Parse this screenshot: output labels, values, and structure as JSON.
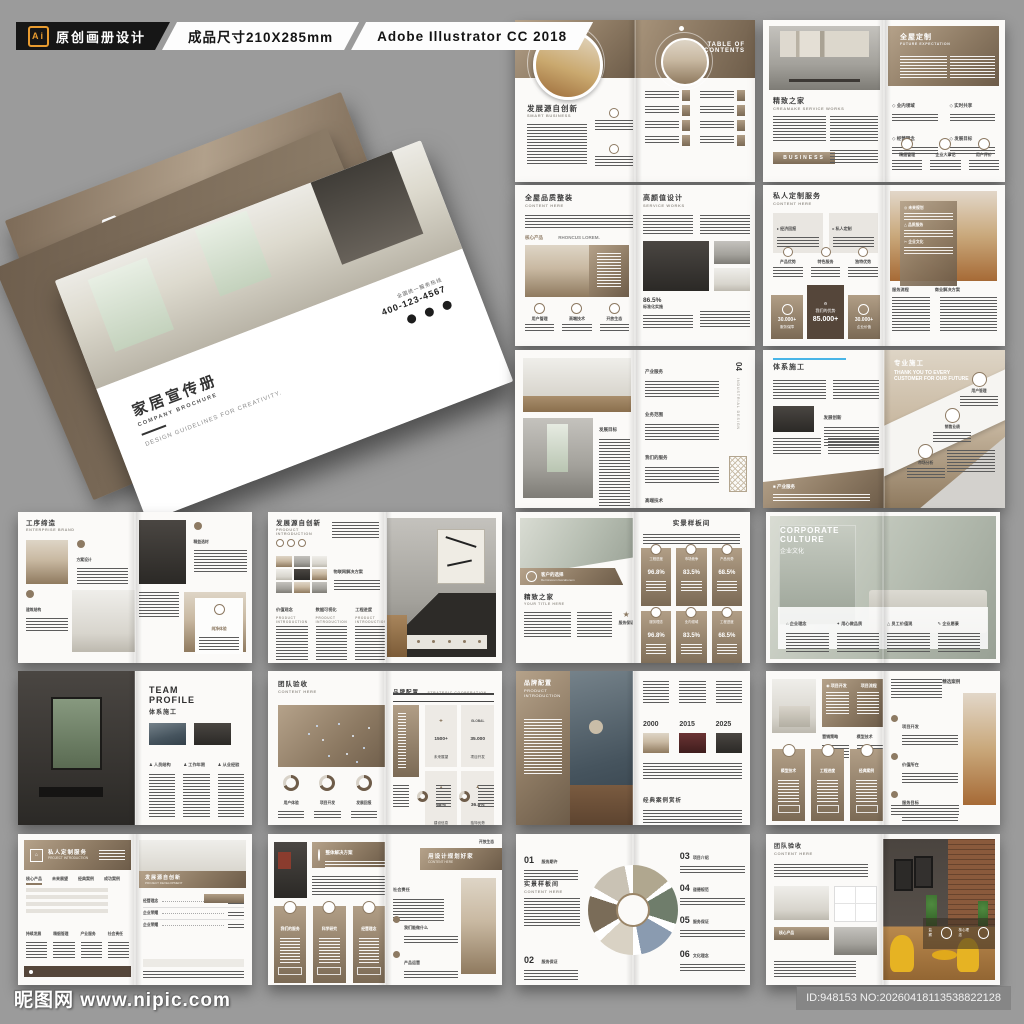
{
  "header": {
    "ai_badge": "Ai",
    "label1": "原创画册设计",
    "label2": "成品尺寸210X285mm",
    "label3": "Adobe Illustrator CC 2018"
  },
  "mockup": {
    "brand_logo": "BRAND",
    "brand_sub": "BUSINESS BROCHURE",
    "cover_title": "家居宣传册",
    "cover_subtitle": "COMPANY BROCHURE",
    "cover_tagline": "DESIGN GUIDELINES FOR CREATIVITY.",
    "hotline_label": "全国统一服务热线",
    "hotline_number": "400-123-4567"
  },
  "footer": {
    "watermark": "昵图网 www.nipic.com",
    "id_text": "ID:948153 NO:20260418113538822128"
  },
  "colors": {
    "background": "#9b9b9b",
    "accent_brown": "#8d7a63",
    "dark_brown": "#55463a",
    "header_black": "#161616",
    "ai_orange": "#e89b2f",
    "blue_accent": "#49b5e7"
  },
  "spreads": {
    "a": {
      "left_title": "发展源自创新",
      "left_sub": "SMART BUSINESS",
      "right_title_line1": "TABLE OF",
      "right_title_line2": "CONTENTS"
    },
    "b": {
      "left_title": "精致之家",
      "left_sub": "CREAMAKE SERVICE WORKS",
      "button": "BUSINESS",
      "right_title": "全屋定制",
      "right_sub": "FUTURE EXPECTATION",
      "bullets": [
        "业内领域",
        "实时共享",
        "经营理念",
        "发展目标"
      ],
      "features": [
        "精细管理",
        "企业大事记",
        "用户评价"
      ]
    },
    "c": {
      "left_title": "全屋品质整装",
      "left_sub": "CONTENT HERE",
      "tag1": "核心产品",
      "tag2": "RHONCUS LOREM.",
      "features": [
        "用户管理",
        "高端技术",
        "开放生态"
      ],
      "right_title": "高颜值设计",
      "right_sub": "SERVICE WORKS",
      "stat_value": "86.5%",
      "stat_label": "标准化实施"
    },
    "d": {
      "left_title": "私人定制服务",
      "left_sub": "CONTENT HERE",
      "boxes": [
        "经济回报",
        "私人定制"
      ],
      "features": [
        "产品优势",
        "特色服务",
        "独特优势"
      ],
      "stat_left_value": "30.000+",
      "stat_left_label": "服务保障",
      "stat_center_title": "我们的优势",
      "stat_center_value": "85.000+",
      "stat_right_value": "30.000+",
      "stat_right_label": "企业价值",
      "overlay_items": [
        "未来规划",
        "品质服务",
        "企业文化"
      ],
      "bottom_labels": [
        "服务流程",
        "商业解决方案"
      ]
    },
    "e": {
      "left_section": "发展目标",
      "right_sections": [
        "产业服务",
        "业务范围",
        "我们的服务",
        "高端技术"
      ],
      "page_no": "04",
      "page_label": "INDUSTRIAL DESIGN"
    },
    "f": {
      "left_title": "体系施工",
      "left_section": "发展创新",
      "band_label": "产业服务",
      "right_title": "专业施工",
      "right_sub": "THANK YOU TO EVERY CUSTOMER FOR OUR FUTURE",
      "steps": [
        "用户管理",
        "销售业绩",
        "市场分析"
      ]
    },
    "g": {
      "title": "工序缔造",
      "sub": "ENTERPRISE BRAND",
      "features": [
        "方案设计",
        "精益选材",
        "建筑结构"
      ],
      "card_label": "纯净体验"
    },
    "h": {
      "title": "发展源自创新",
      "sub1": "PRODUCT",
      "sub2": "INTRODUCTION",
      "tag": "物联网解决方案",
      "columns": [
        "价值观念",
        "数据可视化",
        "工程进度"
      ],
      "column_sub": "Product introduction"
    },
    "i": {
      "ribbon": "客户的选择",
      "ribbon_sub": "Rerminorem faccabonem",
      "left_title": "精致之家",
      "left_sub": "YOUR TITLE HERE",
      "award": "服务保证",
      "right_title": "实景样板间",
      "cards": [
        {
          "label": "工程进度",
          "value": "96.8%"
        },
        {
          "label": "市场竞争",
          "value": "83.5%"
        },
        {
          "label": "产品优势",
          "value": "68.5%"
        },
        {
          "label": "服务理念",
          "value": "96.8%"
        },
        {
          "label": "业内领域",
          "value": "83.5%"
        },
        {
          "label": "工程进度",
          "value": "68.5%"
        }
      ]
    },
    "j": {
      "title_line1": "CORPORATE",
      "title_line2": "CULTURE",
      "title_cn": "企业文化",
      "items": [
        "企业理念",
        "用心做品质",
        "员工价值观",
        "企业愿景"
      ]
    },
    "k": {
      "title_line1": "TEAM",
      "title_line2": "PROFILE",
      "title_cn": "体系施工",
      "columns": [
        "人员结构",
        "工作年限",
        "从业经验"
      ]
    },
    "l": {
      "left_title": "团队验收",
      "left_sub": "CONTENT HERE",
      "donuts": [
        "用户体验",
        "项目开发",
        "发展回报"
      ],
      "right_title": "品牌配置",
      "right_sub": "STRATEGIC COOPERATION",
      "stats": [
        {
          "value": "1500+",
          "label": "未来展望",
          "tag": ""
        },
        {
          "value": "35.000",
          "label": "项目开发",
          "tag": "GLOBAL"
        },
        {
          "value": "68%",
          "label": "建设信息",
          "tag": ""
        },
        {
          "value": "36.8%",
          "label": "独特优势",
          "tag": ""
        }
      ]
    },
    "m": {
      "left_title": "品牌配置",
      "left_sub1": "PRODUCT",
      "left_sub2": "INTRODUCTION",
      "years": [
        "2000",
        "2015",
        "2025"
      ],
      "bottom_title": "经典案例赏析"
    },
    "n": {
      "banner_left": "项目开发",
      "banner_right": "项目流程",
      "sections": [
        "营销策略",
        "模型技术"
      ],
      "cards": [
        "模型技术",
        "工程进度",
        "经典案例"
      ],
      "right_top": "精选案例",
      "bullets": [
        "项目开发",
        "价值所在",
        "服务目标"
      ]
    },
    "o": {
      "left_title": "私人定制服务",
      "left_sub": "PROJECT INTRODUCTION",
      "tabs": [
        "核心产品",
        "未来展望",
        "经典案例",
        "成功案例"
      ],
      "labels": [
        "持续发展",
        "精细管理",
        "产业服务",
        "社会责任"
      ],
      "right_title": "发展源自创新",
      "right_sub": "PROJECT DEVELOPMENT",
      "rows": [
        "经营理念",
        "企业荣耀",
        "企业荣耀"
      ]
    },
    "p": {
      "banner": "整体解决方案",
      "cards": [
        "我们的服务",
        "科学研究",
        "经营理念"
      ],
      "right_title": "用设计规划好家",
      "right_sub": "CONTENT HERE",
      "section": "社会责任",
      "bullets": [
        "我们能做什么",
        "产品运营",
        "杰出定位"
      ],
      "corner": "开放生态"
    },
    "q": {
      "left_title": "实景样板间",
      "left_sub": "CONTENT HERE",
      "items": [
        {
          "no": "01",
          "label": "服务期许"
        },
        {
          "no": "02",
          "label": "服务保证"
        },
        {
          "no": "03",
          "label": "项目介绍"
        },
        {
          "no": "04",
          "label": "道德规范"
        },
        {
          "no": "05",
          "label": "服务保证"
        },
        {
          "no": "06",
          "label": "文化理念"
        }
      ]
    },
    "r": {
      "left_title": "团队验收",
      "left_sub": "CONTENT HERE",
      "tag": "核心产品",
      "photo_tags": [
        "监察",
        "核心理念"
      ]
    }
  }
}
